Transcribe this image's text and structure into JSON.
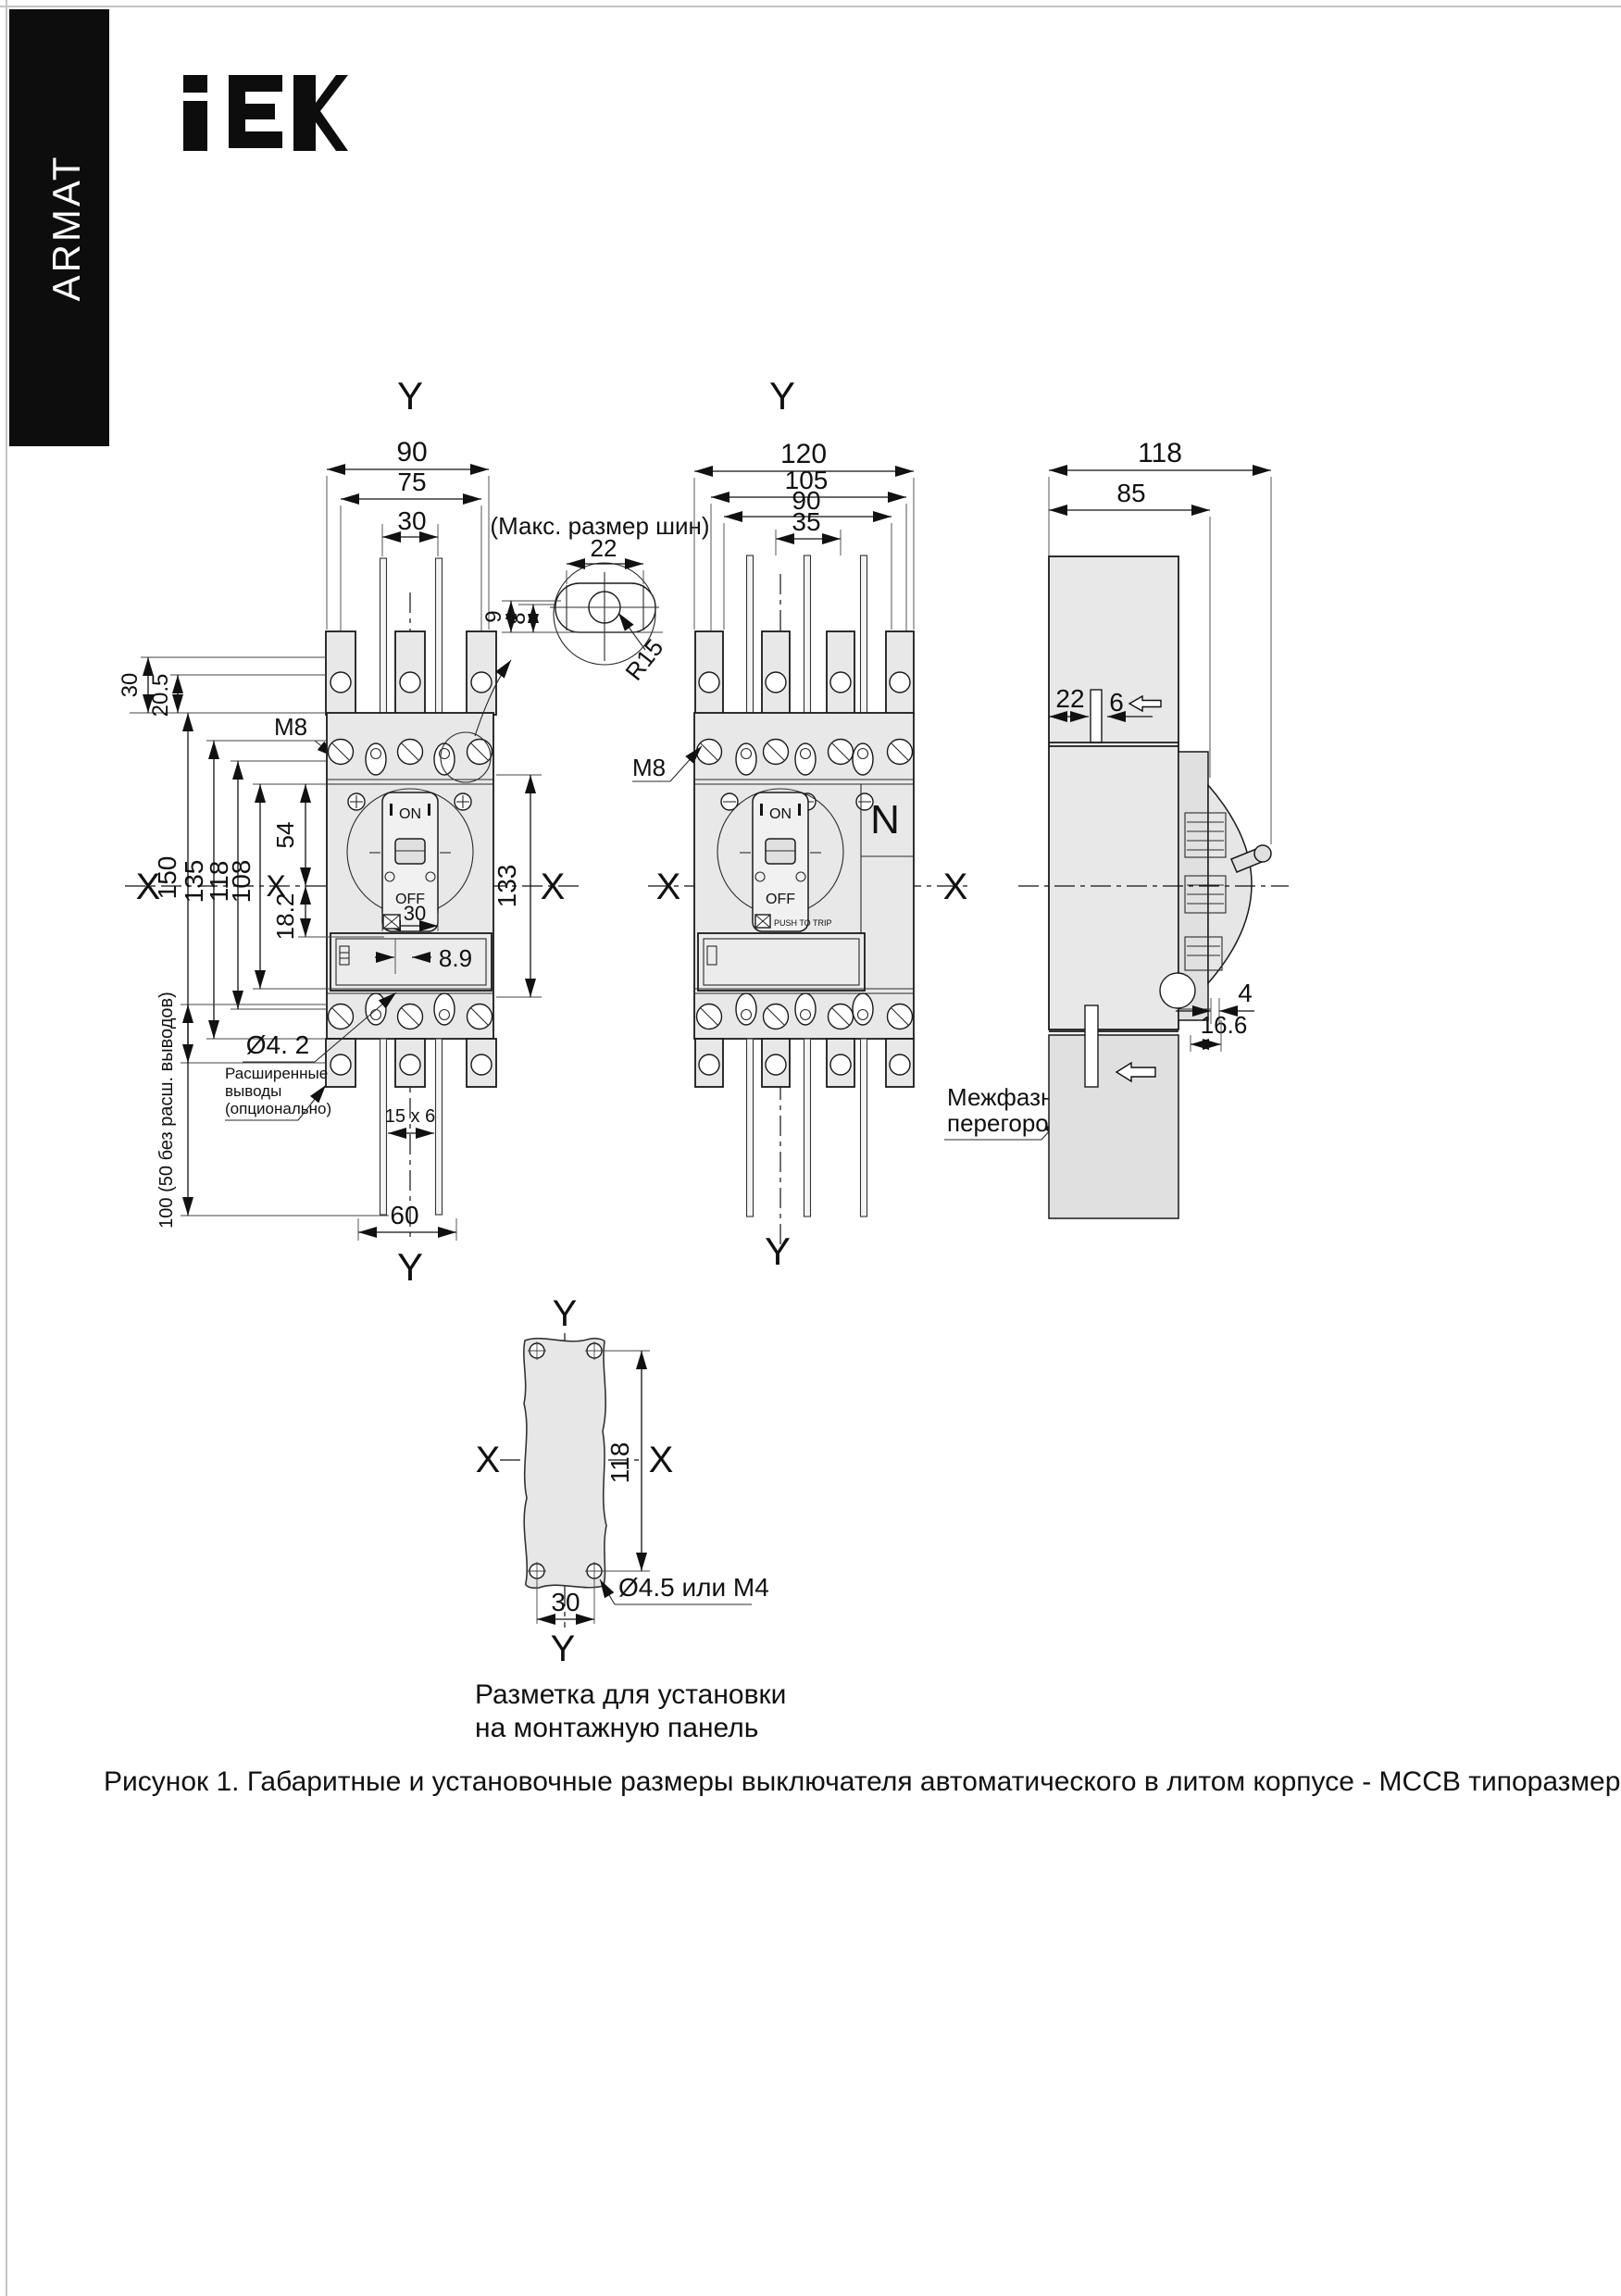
{
  "brand": {
    "armat": "ARMAT",
    "iek_logo": "IEK"
  },
  "captions": {
    "mounting_line1": "Разметка для установки",
    "mounting_line2": "на монтажную панель",
    "figure": "Рисунок 1. Габаритные и установочные размеры выключателя автоматического в литом корпусе - MCCB типоразмера A"
  },
  "front3p": {
    "y_axis": "Y",
    "x_axis": "X",
    "dim_width_total": "90",
    "dim_width_holes": "75",
    "dim_width_pitch": "30",
    "dim_tab_30": "30",
    "dim_tab_205": "20.5",
    "thread": "M8",
    "dim_h_150": "150",
    "dim_h_135": "135",
    "dim_h_118": "118",
    "dim_h_108": "108",
    "dim_54": "54",
    "dim_182": "18.2",
    "dim_h_133": "133",
    "on": "ON",
    "off": "OFF",
    "dim_30_handle": "30",
    "dim_89": "8.9",
    "hole_label": "Ø4. 2",
    "ext_line1": "Расширенные",
    "ext_line2": "выводы",
    "ext_line3": "(опционально)",
    "dim_100": "100 (50 без расш. выводов)",
    "bus_size": "15 x 6",
    "dim_60": "60"
  },
  "bus_detail": {
    "title": "(Макс. размер шин)",
    "dim_22": "22",
    "dim_9": "9",
    "dim_8": "8",
    "radius": "R15"
  },
  "front4p": {
    "y_axis": "Y",
    "x_axis": "X",
    "dim_120": "120",
    "dim_105": "105",
    "dim_90": "90",
    "dim_35": "35",
    "thread": "M8",
    "neutral": "N",
    "on": "ON",
    "off": "OFF",
    "push_to_trip": "PUSH TO TRIP",
    "barrier_line1": "Межфазная",
    "barrier_line2": "перегородка"
  },
  "side": {
    "dim_118": "118",
    "dim_85": "85",
    "dim_22": "22",
    "dim_6": "6",
    "dim_4": "4",
    "dim_166": "16.6"
  },
  "mounting": {
    "y_axis": "Y",
    "x_axis": "X",
    "dim_118": "118",
    "dim_30": "30",
    "hole_label": "Ø4.5 или M4"
  }
}
